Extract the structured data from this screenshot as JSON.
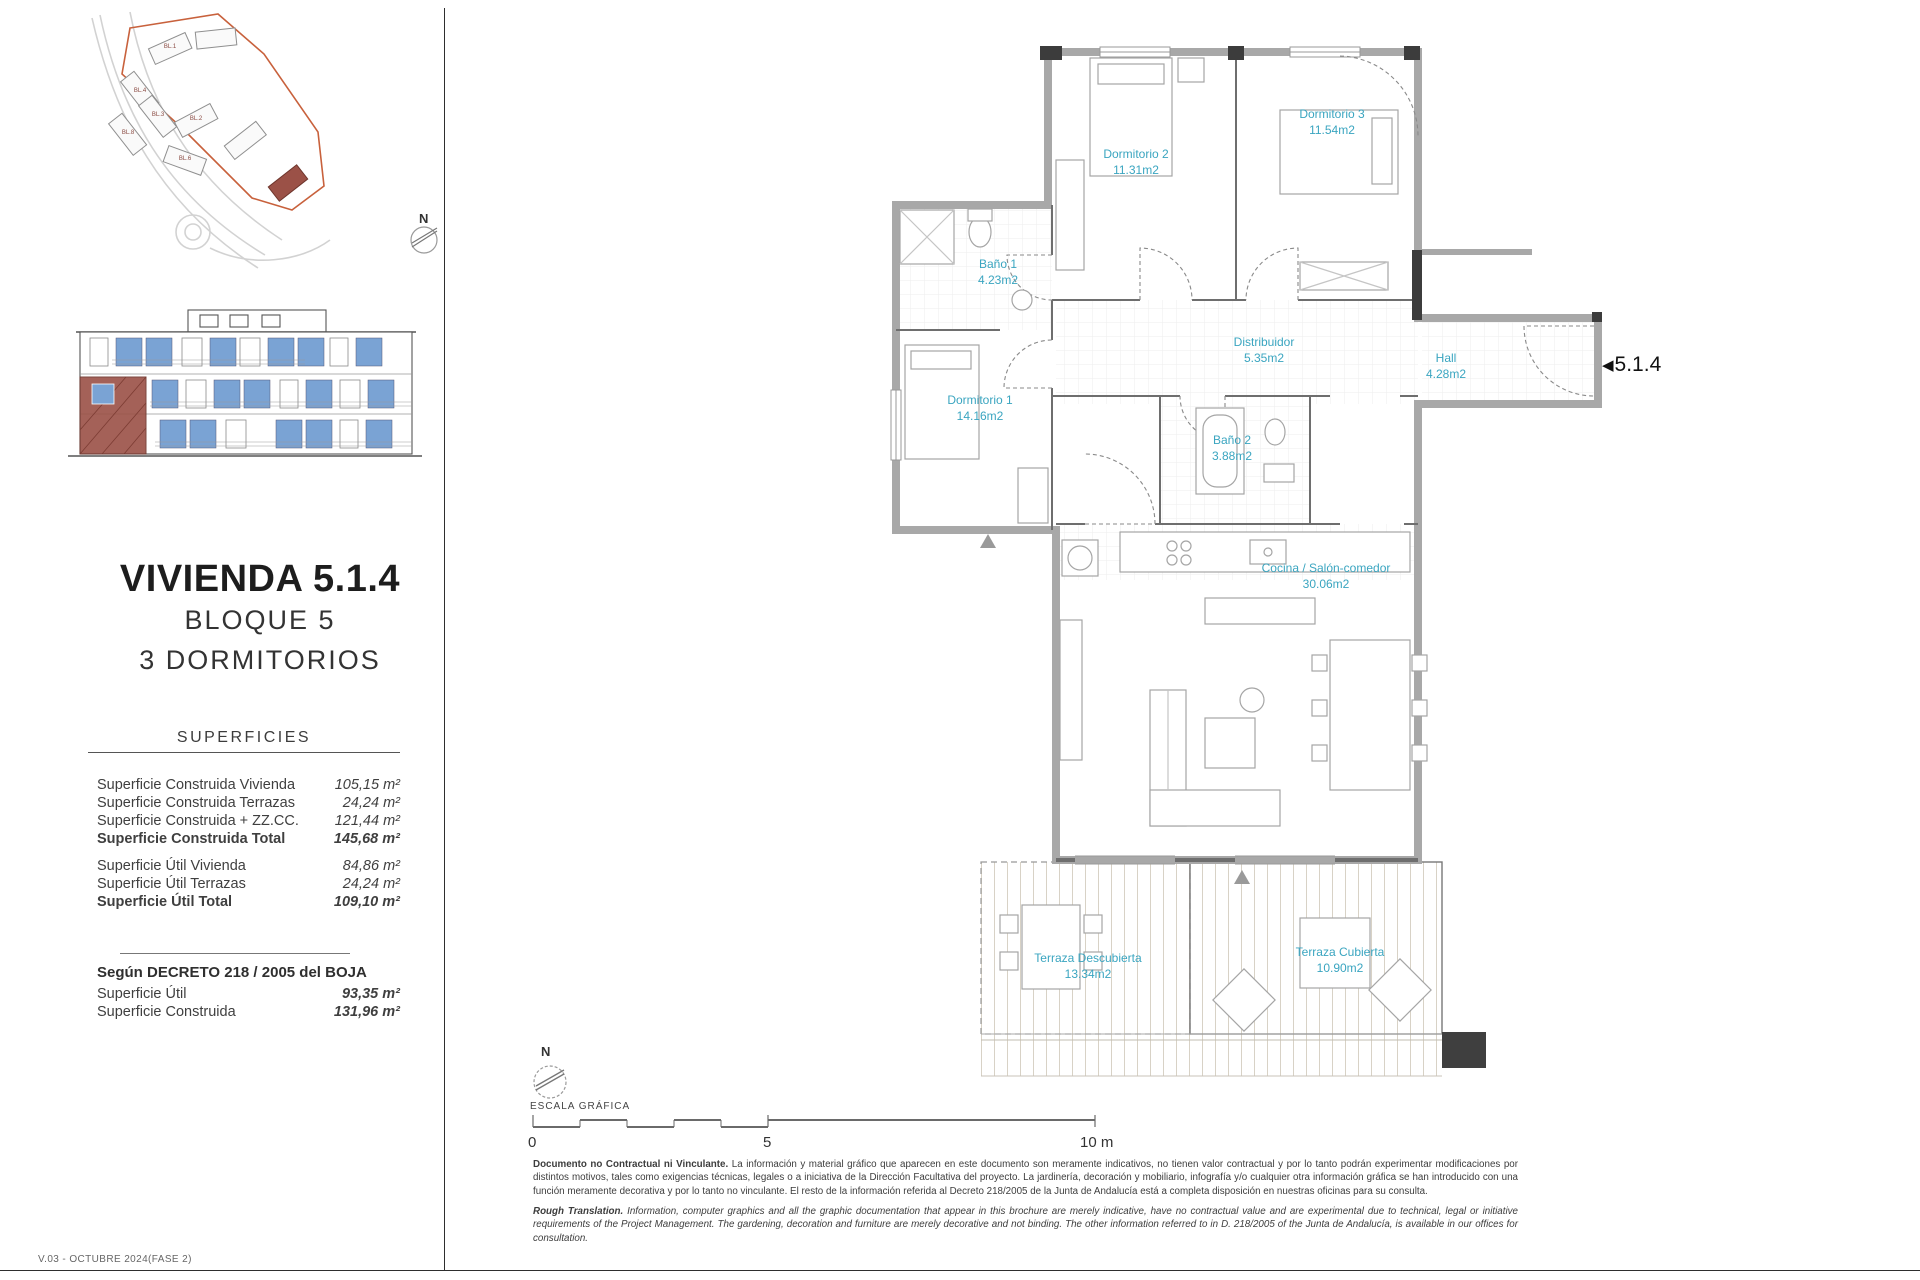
{
  "theme": {
    "accent_teal": "#3AA5C0",
    "window_blue": "#7AA3D4",
    "highlight_red": "#9B5147",
    "boundary_orange": "#C8613C",
    "wall_gray": "#A8A8A8",
    "text_dark": "#2B2B2B"
  },
  "page": {
    "version": "V.03 - OCTUBRE 2024(FASE 2)"
  },
  "header": {
    "title": "VIVIENDA 5.1.4",
    "subtitle_block": "BLOQUE 5",
    "subtitle_rooms": "3 DORMITORIOS"
  },
  "superficies": {
    "heading": "SUPERFICIES",
    "construida": [
      {
        "label": "Superficie Construida Vivienda",
        "value": "105,15 m²"
      },
      {
        "label": "Superficie Construida Terrazas",
        "value": "24,24 m²"
      },
      {
        "label": "Superficie Construida + ZZ.CC.",
        "value": "121,44 m²"
      },
      {
        "label": "Superficie Construida Total",
        "value": "145,68 m²"
      }
    ],
    "util": [
      {
        "label": "Superficie Útil Vivienda",
        "value": "84,86 m²"
      },
      {
        "label": "Superficie Útil Terrazas",
        "value": "24,24 m²"
      },
      {
        "label": "Superficie Útil Total",
        "value": "109,10 m²"
      }
    ]
  },
  "decreto": {
    "heading": "Según DECRETO 218 / 2005 del BOJA",
    "rows": [
      {
        "label": "Superficie Útil",
        "value": "93,35 m²"
      },
      {
        "label": "Superficie Construida",
        "value": "131,96 m²"
      }
    ]
  },
  "site_plan": {
    "north": "N",
    "block_labels": [
      "BL.1",
      "BL.2",
      "BL.3",
      "BL.4",
      "BL.6",
      "BL.8"
    ]
  },
  "plan": {
    "marker": "5.1.4",
    "rooms": {
      "dormitorio2": {
        "name": "Dormitorio 2",
        "area": "11.31m2"
      },
      "dormitorio3": {
        "name": "Dormitorio 3",
        "area": "11.54m2"
      },
      "bano1": {
        "name": "Baño 1",
        "area": "4.23m2"
      },
      "distribuidor": {
        "name": "Distribuidor",
        "area": "5.35m2"
      },
      "hall": {
        "name": "Hall",
        "area": "4.28m2"
      },
      "dormitorio1": {
        "name": "Dormitorio 1",
        "area": "14.16m2"
      },
      "bano2": {
        "name": "Baño 2",
        "area": "3.88m2"
      },
      "cocina": {
        "name": "Cocina / Salón-comedor",
        "area": "30.06m2"
      },
      "terraza_descubierta": {
        "name": "Terraza Descubierta",
        "area": "13.34m2"
      },
      "terraza_cubierta": {
        "name": "Terraza Cubierta",
        "area": "10.90m2"
      }
    }
  },
  "scale": {
    "north": "N",
    "label": "ESCALA GRÁFICA",
    "ticks": [
      "0",
      "5",
      "10 m"
    ]
  },
  "disclaimer": {
    "es_title": "Documento no Contractual ni Vinculante.",
    "es_body": "La información y material gráfico que aparecen en este documento son meramente indicativos, no tienen valor contractual y por lo tanto podrán experimentar modificaciones por distintos motivos, tales como exigencias técnicas, legales o a iniciativa de la Dirección Facultativa del proyecto. La jardinería, decoración y mobiliario, infografía y/o cualquier otra información gráfica se han introducido con una función meramente decorativa y por lo tanto no vinculante. El resto de la información referida al Decreto 218/2005 de la Junta de Andalucía está a completa disposición en nuestras oficinas para su consulta.",
    "en_title": "Rough Translation.",
    "en_body": "Information, computer graphics and all the graphic documentation that appear in this brochure are merely indicative, have no contractual value and are experimental due to technical, legal or initiative requirements of the Project Management. The gardening, decoration and furniture are merely decorative and not binding. The other information referred to in D. 218/2005 of the Junta de Andalucía, is available in our offices for consultation."
  }
}
